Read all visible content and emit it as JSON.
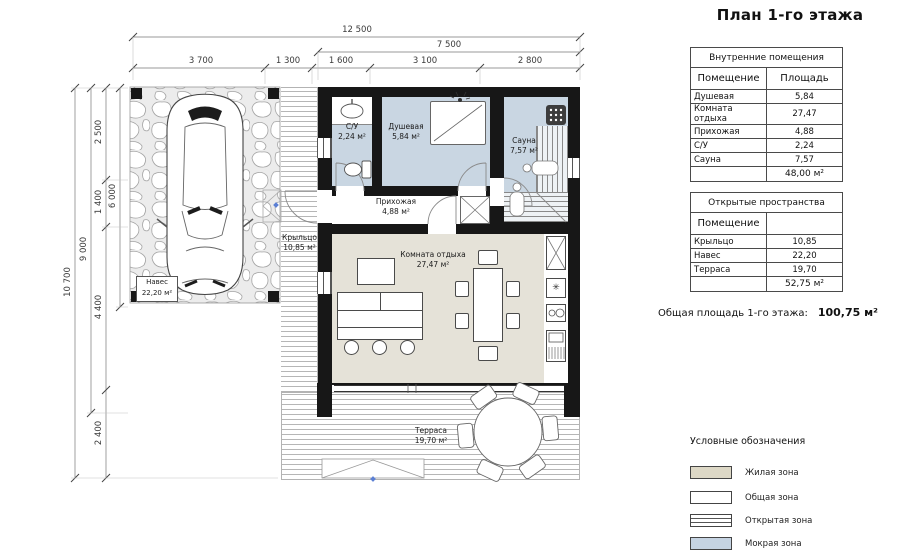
{
  "page_title": "План 1-го этажа",
  "colors": {
    "wall": "#171717",
    "wet_zone": "#c9d6e2",
    "living_zone": "#e5e2d8",
    "legend_living": "#ddd8c6",
    "legend_wet": "#c5d3e2",
    "deck_line": "#b6b6b6"
  },
  "icons": {
    "snowflake": "✳"
  },
  "dimensions": {
    "top": {
      "total": "12 500",
      "right_block": "7 500",
      "segments": [
        "3 700",
        "1 300",
        "1 600",
        "3 100",
        "2 800"
      ]
    },
    "left": {
      "total": "10 700",
      "house": "9 000",
      "carport_depth": "6 000",
      "segments": [
        "2 500",
        "1 400",
        "4 400",
        "2 400"
      ]
    }
  },
  "rooms": {
    "wc": {
      "name": "С/У",
      "area": "2,24 м²"
    },
    "shower": {
      "name": "Душевая",
      "area": "5,84 м²"
    },
    "sauna": {
      "name": "Сауна",
      "area": "7,57 м²"
    },
    "hall": {
      "name": "Прихожая",
      "area": "4,88 м²"
    },
    "lounge": {
      "name": "Комната отдыха",
      "area": "27,47 м²"
    },
    "porch": {
      "name": "Крыльцо",
      "area": "10,85 м²"
    },
    "carport": {
      "name": "Навес",
      "area": "22,20 м²"
    },
    "terrace": {
      "name": "Терраса",
      "area": "19,70 м²"
    }
  },
  "interior_table": {
    "title": "Внутренние помещения",
    "col_room": "Помещение",
    "col_area": "Площадь",
    "rows": [
      {
        "name": "Душевая",
        "area": "5,84"
      },
      {
        "name": "Комната отдыха",
        "area": "27,47"
      },
      {
        "name": "Прихожая",
        "area": "4,88"
      },
      {
        "name": "С/У",
        "area": "2,24"
      },
      {
        "name": "Сауна",
        "area": "7,57"
      }
    ],
    "total": "48,00 м²"
  },
  "open_table": {
    "title": "Открытые пространства",
    "col_room": "Помещение",
    "col_area": "",
    "rows": [
      {
        "name": "Крыльцо",
        "area": "10,85"
      },
      {
        "name": "Навес",
        "area": "22,20"
      },
      {
        "name": "Терраса",
        "area": "19,70"
      }
    ],
    "total": "52,75 м²"
  },
  "total_area": {
    "label": "Общая площадь 1-го этажа:",
    "value": "100,75 м²"
  },
  "legend": {
    "title": "Условные обозначения",
    "items": [
      {
        "label": "Жилая зона"
      },
      {
        "label": "Общая зона"
      },
      {
        "label": "Открытая зона"
      },
      {
        "label": "Мокрая зона"
      }
    ]
  }
}
